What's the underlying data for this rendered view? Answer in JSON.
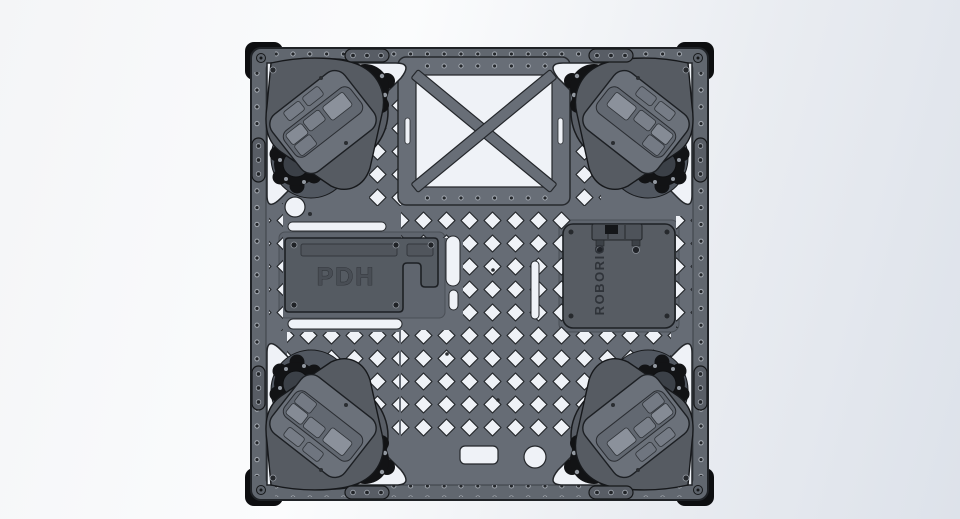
{
  "scene": {
    "type": "cad-top-view-render",
    "description": "Top view CAD render of a square FRC swerve drivetrain chassis plate"
  },
  "labels": {
    "pdh": "PDH",
    "roborio": "ROBORIO"
  },
  "colors": {
    "background_light": "#fbfcfd",
    "background_shade": "#dde2ea",
    "plate": "#666c75",
    "module_body": "#565b62",
    "module_plate": "#6b717a",
    "hardware_black": "#121315",
    "cutout": "#eff2f7",
    "edge_line": "#1f2226"
  },
  "components": {
    "chassis": "chassis-plate",
    "brace": "x-brace-panel",
    "power": "power-distribution-hub",
    "controller": "roborio-controller",
    "modules": [
      "swerve-module-front-left",
      "swerve-module-front-right",
      "swerve-module-rear-left",
      "swerve-module-rear-right"
    ]
  }
}
